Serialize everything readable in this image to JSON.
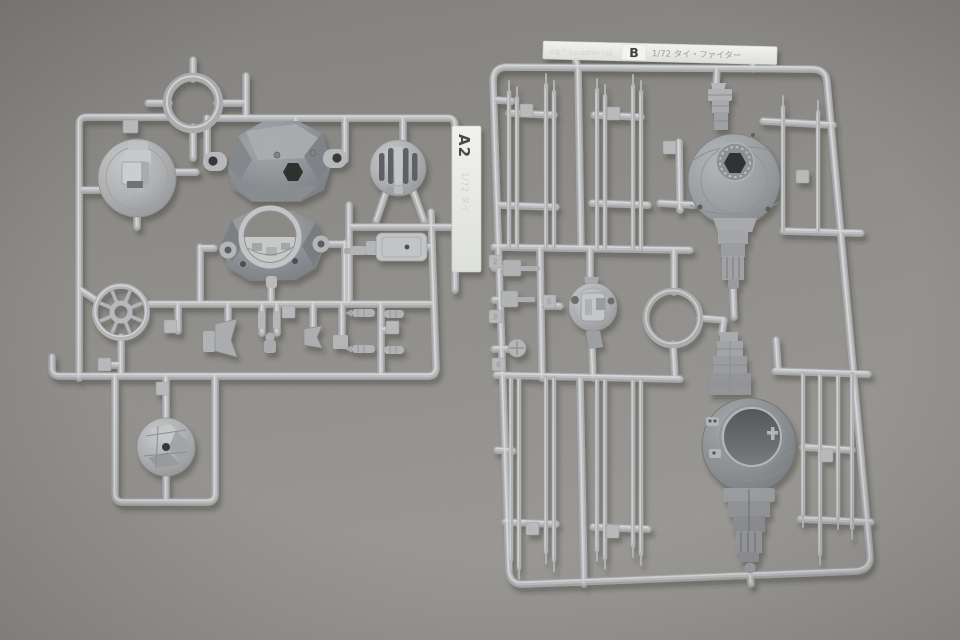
{
  "photo": {
    "subject": "Injection-molded plastic model kit sprues (runners) with parts, photographed on a gray surface",
    "kit_scale": "1/72"
  },
  "left_sprue": {
    "tag_code": "A2",
    "tag_embossed": "1/72 タイ"
  },
  "right_sprue": {
    "label_embossed": "©&™ Lucasfilm Ltd.",
    "label_code": "B",
    "label_title": "1/72 タイ・ファイター",
    "part_number_tags": [
      "2",
      "3",
      "4",
      "5"
    ]
  },
  "colors": {
    "background": "#8e8c89",
    "plastic": "#b2b4b6",
    "plastic_highlight": "#d6d7d8",
    "plastic_dark": "#888b8f",
    "label_plate": "#eceee9",
    "label_text": "#4a4a48"
  }
}
